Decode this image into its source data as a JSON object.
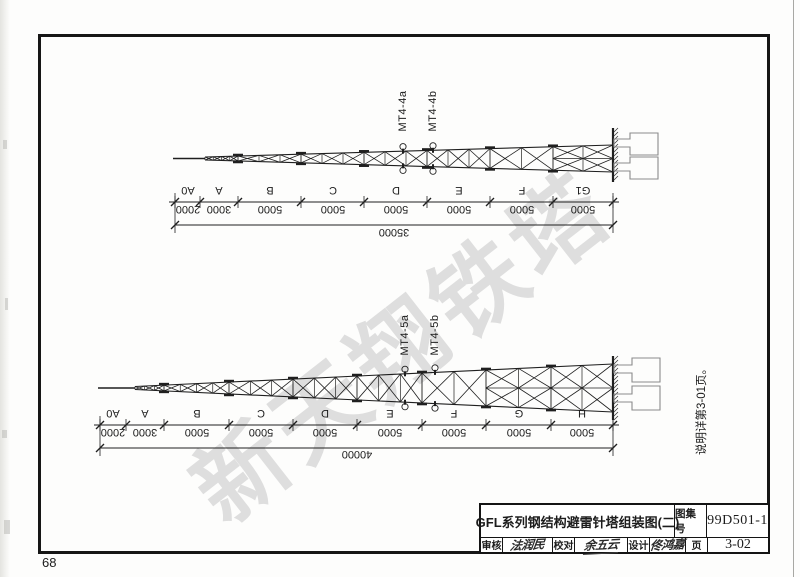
{
  "page": {
    "folio": "68"
  },
  "watermark": {
    "text": "新天翔铁塔",
    "color": "#d9d9d9"
  },
  "side_note": "说明详第3-01页。",
  "top_diagram": {
    "flange_labels": [
      "MT4-4a",
      "MT4-4b"
    ],
    "segments": [
      {
        "label": "A0",
        "dim": "2000"
      },
      {
        "label": "A",
        "dim": "3000"
      },
      {
        "label": "B",
        "dim": "5000"
      },
      {
        "label": "C",
        "dim": "5000"
      },
      {
        "label": "D",
        "dim": "5000"
      },
      {
        "label": "E",
        "dim": "5000"
      },
      {
        "label": "F",
        "dim": "5000"
      },
      {
        "label": "G1",
        "dim": "5000"
      }
    ],
    "total": "35000"
  },
  "bottom_diagram": {
    "flange_labels": [
      "MT4-5a",
      "MT4-5b"
    ],
    "segments": [
      {
        "label": "A0",
        "dim": "2000"
      },
      {
        "label": "A",
        "dim": "3000"
      },
      {
        "label": "B",
        "dim": "5000"
      },
      {
        "label": "C",
        "dim": "5000"
      },
      {
        "label": "D",
        "dim": "5000"
      },
      {
        "label": "E",
        "dim": "5000"
      },
      {
        "label": "F",
        "dim": "5000"
      },
      {
        "label": "G",
        "dim": "5000"
      },
      {
        "label": "H",
        "dim": "5000"
      }
    ],
    "total": "40000"
  },
  "title_block": {
    "title": "GFL系列钢结构避雷针塔组装图(二)",
    "atlas_label": "图集号",
    "atlas_number": "99D501-1",
    "review_label": "审核",
    "review_signature": "法润民",
    "proof_label": "校对",
    "proof_signature": "余五云",
    "design_label": "设计",
    "design_signature": "佟鸿嘉",
    "page_label": "页",
    "page_number": "3-02"
  }
}
